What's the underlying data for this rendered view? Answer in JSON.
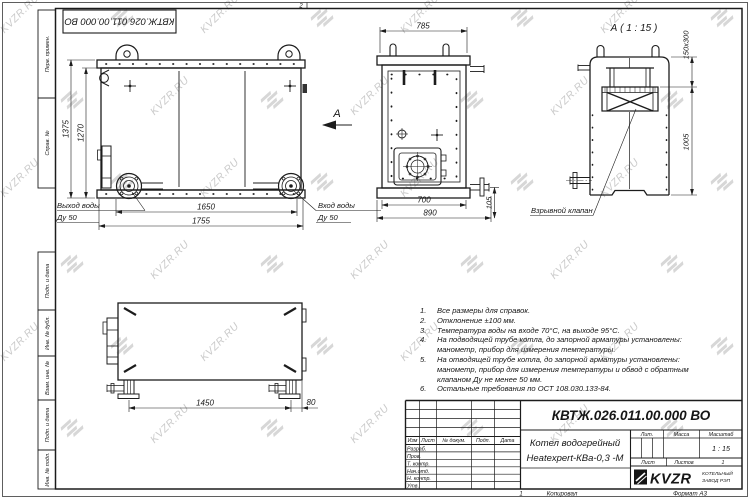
{
  "watermark": {
    "text": "KVZR.RU",
    "color": "#bdbdbd"
  },
  "colors": {
    "line": "#1c1c1c",
    "paper": "#ffffff"
  },
  "frame": {
    "top_doc_number": "КВТЖ.026.011.00.000 ВО",
    "zone_top": "2",
    "zone_bottom": "1",
    "copy_label": "Копировал",
    "format_label": "Формат А3",
    "side_labels": [
      "Перв. примен.",
      "Справ. №",
      "Подп. и дата",
      "Инв. № дубл.",
      "Взам. инв. №",
      "Подп. и дата",
      "Инв. № подл."
    ]
  },
  "views": {
    "front": {
      "dims": {
        "overall_height": "1375",
        "body_height": "1270",
        "flange_span": "1650",
        "overall_width": "1755"
      },
      "outlet_label_1": "Выход воды",
      "outlet_label_2": "Ду 50",
      "inlet_label_1": "Вход воды",
      "inlet_label_2": "Ду 50",
      "view_arrow": "А"
    },
    "side": {
      "dims": {
        "overall_width": "785",
        "body_width": "700",
        "width_with_pipe": "890",
        "pipe_offset": "105"
      }
    },
    "detail": {
      "title": "А ( 1 : 15 )",
      "dims": {
        "chimney_section": "150х300",
        "chimney_height": "1005"
      },
      "valve_label": "Взрывной клапан"
    },
    "bottom": {
      "dims": {
        "support_span": "1450",
        "edge_offset": "80"
      }
    }
  },
  "notes": [
    [
      "Все размеры для справок."
    ],
    [
      "Отклонение ±100 мм."
    ],
    [
      "Температура воды на входе 70°С, на выходе 95°С."
    ],
    [
      "На подводящей трубе котла, до запорной арматуры установлены:",
      "манометр, прибор для измерения температуры."
    ],
    [
      "На отводящей трубе котла, до запорной арматуры установлены:",
      "манометр, прибор для измерения температуры и обвод с обратным",
      "клапаном Ду не менее 50 мм."
    ],
    [
      "Остальные требования по ОСТ 108.030.133-84."
    ]
  ],
  "title_block": {
    "doc_number": "КВТЖ.026.011.00.000 ВО",
    "product_name_1": "Котел водогрейный",
    "product_name_2": "Heatexpert-КВа-0,3 -М",
    "col_headers": [
      "Изм",
      "Лист",
      "№ докум.",
      "Подп.",
      "Дата"
    ],
    "row_labels": [
      "Разраб.",
      "Пров.",
      "Т. контр.",
      "Нач.отд.",
      "Н. контр.",
      "Утв."
    ],
    "lit_label": "Лит.",
    "mass_label": "Масса",
    "scale_label": "Масштаб",
    "scale_value": "1 : 15",
    "sheet_label": "Лист",
    "sheets_label": "Листов",
    "sheets_value": "1",
    "logo_text": "KVZR",
    "company_line_1": "КОТЕЛЬНЫЙ",
    "company_line_2": "ЗАВОД РЭП"
  }
}
